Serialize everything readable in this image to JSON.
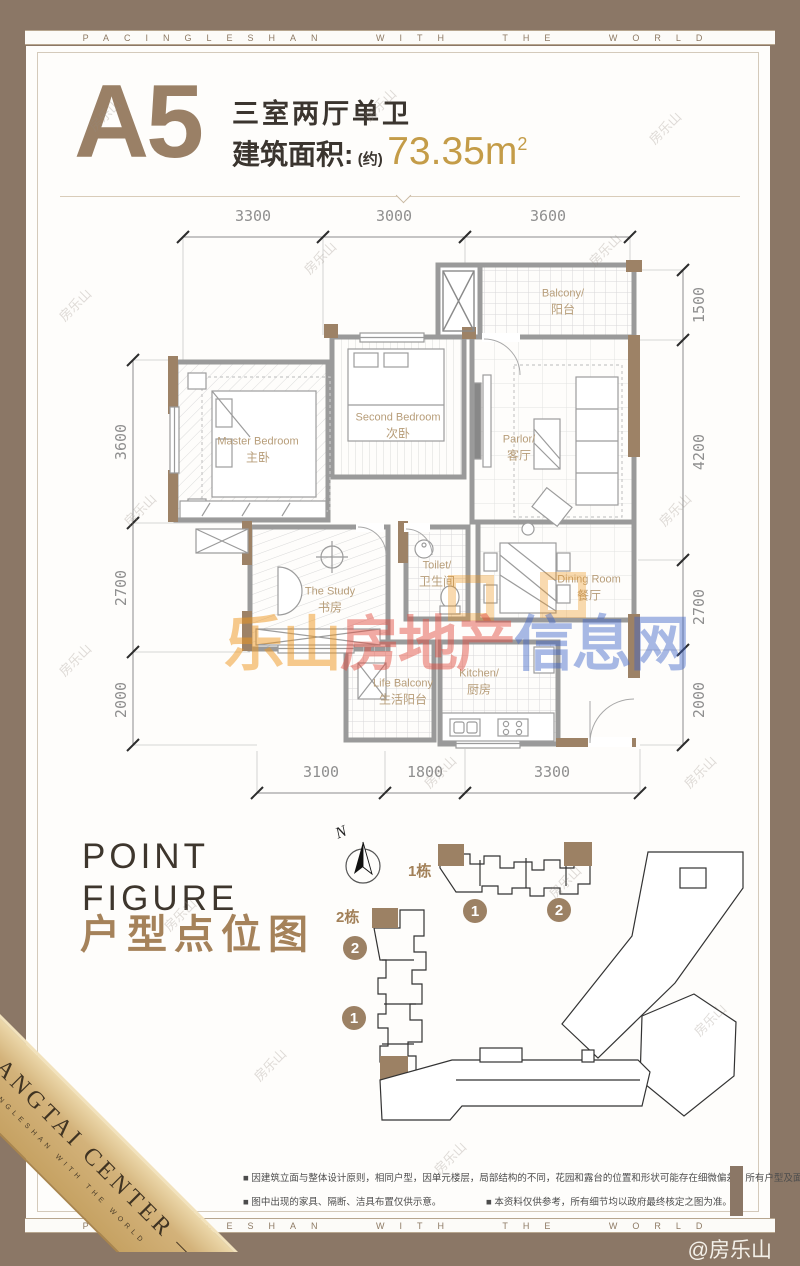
{
  "banner": {
    "text": "PACINGLESHAN WITH THE WORLD"
  },
  "header": {
    "unit": "A5",
    "layout_type": "三室两厅单卫",
    "area_label": "建筑面积:",
    "area_paren": "(约)",
    "area_value": "73.35m",
    "area_exp": "2"
  },
  "floorplan": {
    "dims_top": [
      "3300",
      "3000",
      "3600"
    ],
    "dims_bottom": [
      "3100",
      "1800",
      "3300"
    ],
    "dims_left": [
      "3600",
      "2700",
      "2000"
    ],
    "dims_right": [
      "1500",
      "4200",
      "2700",
      "2000"
    ],
    "rooms": [
      {
        "en": "Master Bedroom",
        "zh": "主卧"
      },
      {
        "en": "Second Bedroom",
        "zh": "次卧"
      },
      {
        "en": "Parlor/",
        "zh": "客厅"
      },
      {
        "en": "Balcony/",
        "zh": "阳台"
      },
      {
        "en": "The Study",
        "zh": "书房"
      },
      {
        "en": "Toilet/",
        "zh": "卫生间"
      },
      {
        "en": "Dining Room",
        "zh": "餐厅"
      },
      {
        "en": "Kitchen/",
        "zh": "厨房"
      },
      {
        "en": "Life Balcony",
        "zh": "生活阳台"
      }
    ]
  },
  "watermark": {
    "small": "房乐山",
    "big_part1": "乐山",
    "big_part2": "房地产",
    "big_part3": "信息网"
  },
  "point_figure": {
    "title_en_line1": "POINT",
    "title_en_line2": "FIGURE",
    "title_zh": "户型点位图",
    "north": "N",
    "tower1_label": "1栋",
    "tower2_label": "2栋",
    "tower1_units": [
      "1",
      "2"
    ],
    "tower2_units": [
      "2",
      "1"
    ]
  },
  "ribbon": {
    "title": "BANGTAI CENTER",
    "subtitle": "PACINGLESHAN WITH THE WORLD"
  },
  "disclaimer": {
    "line1": "■ 因建筑立面与整体设计原则，相同户型，因单元楼层，局部结构的不同，花园和露台的位置和形状可能存在细微偏差，所有户型及面积以政府最终测绘面积为准。",
    "line2a": "■ 图中出现的家具、隔断、洁具布置仅供示意。",
    "line2b": "■ 本资料仅供参考，所有细节均以政府最终核定之图为准。"
  },
  "footer": {
    "credit": "@房乐山"
  }
}
